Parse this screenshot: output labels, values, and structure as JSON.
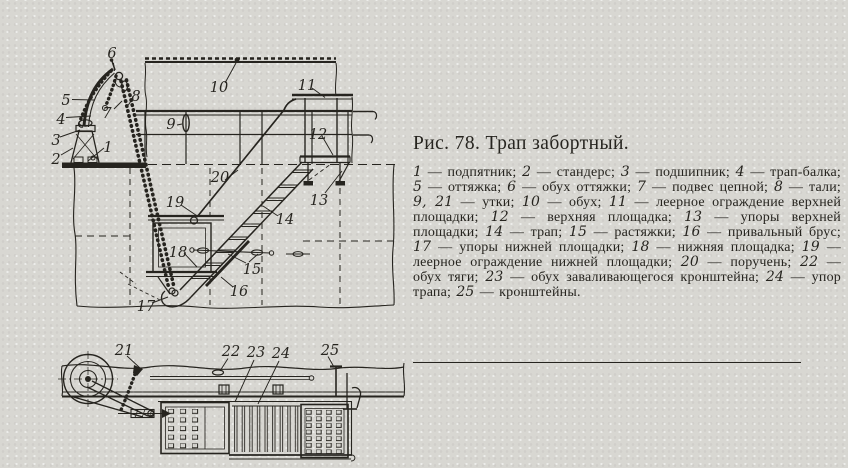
{
  "colors": {
    "paper": "#d8d7d2",
    "ink": "#26241f"
  },
  "figure": {
    "title": "Рис. 78. Трап забортный.",
    "dash": " — ",
    "item_separator": "; ",
    "terminator": ".",
    "legend": [
      {
        "num": "1",
        "name": "подпятник"
      },
      {
        "num": "2",
        "name": "стандерс"
      },
      {
        "num": "3",
        "name": "подшипник"
      },
      {
        "num": "4",
        "name": "трап-балка"
      },
      {
        "num": "5",
        "name": "оттяжка"
      },
      {
        "num": "6",
        "name": "обух оттяжки"
      },
      {
        "num": "7",
        "name": "подвес цепной"
      },
      {
        "num": "8",
        "name": "тали"
      },
      {
        "num": "9, 21",
        "name": "утки"
      },
      {
        "num": "10",
        "name": "обух"
      },
      {
        "num": "11",
        "name": "леерное ограждение верхней площадки"
      },
      {
        "num": "12",
        "name": "верхняя площадка"
      },
      {
        "num": "13",
        "name": "упоры верхней площадки"
      },
      {
        "num": "14",
        "name": "трап"
      },
      {
        "num": "15",
        "name": "растяжки"
      },
      {
        "num": "16",
        "name": "привальный брус"
      },
      {
        "num": "17",
        "name": "упоры нижней площадки"
      },
      {
        "num": "18",
        "name": "нижняя площадка"
      },
      {
        "num": "19",
        "name": "леерное ограждение нижней площадки"
      },
      {
        "num": "20",
        "name": "поручень"
      },
      {
        "num": "22",
        "name": "обух тяги"
      },
      {
        "num": "23",
        "name": "обух заваливающегося кронштейна"
      },
      {
        "num": "24",
        "name": "упор трапа"
      },
      {
        "num": "25",
        "name": "кронштейны"
      }
    ]
  },
  "diagram": {
    "callouts": [
      {
        "t": "1",
        "x": 108,
        "y": 152
      },
      {
        "t": "2",
        "x": 56,
        "y": 164
      },
      {
        "t": "3",
        "x": 56,
        "y": 145
      },
      {
        "t": "4",
        "x": 61,
        "y": 124
      },
      {
        "t": "5",
        "x": 66,
        "y": 105
      },
      {
        "t": "6",
        "x": 112,
        "y": 58
      },
      {
        "t": "7",
        "x": 107,
        "y": 118
      },
      {
        "t": "8",
        "x": 136,
        "y": 101
      },
      {
        "t": "9",
        "x": 171,
        "y": 129
      },
      {
        "t": "10",
        "x": 219,
        "y": 92
      },
      {
        "t": "11",
        "x": 307,
        "y": 90
      },
      {
        "t": "12",
        "x": 318,
        "y": 139
      },
      {
        "t": "13",
        "x": 319,
        "y": 205
      },
      {
        "t": "14",
        "x": 285,
        "y": 224
      },
      {
        "t": "15",
        "x": 252,
        "y": 274
      },
      {
        "t": "16",
        "x": 239,
        "y": 296
      },
      {
        "t": "17",
        "x": 146,
        "y": 311
      },
      {
        "t": "18",
        "x": 178,
        "y": 257
      },
      {
        "t": "19",
        "x": 175,
        "y": 207
      },
      {
        "t": "20",
        "x": 220,
        "y": 182
      },
      {
        "t": "21",
        "x": 124,
        "y": 355
      },
      {
        "t": "22",
        "x": 231,
        "y": 356
      },
      {
        "t": "23",
        "x": 256,
        "y": 357
      },
      {
        "t": "24",
        "x": 281,
        "y": 358
      },
      {
        "t": "25",
        "x": 330,
        "y": 355
      }
    ]
  }
}
